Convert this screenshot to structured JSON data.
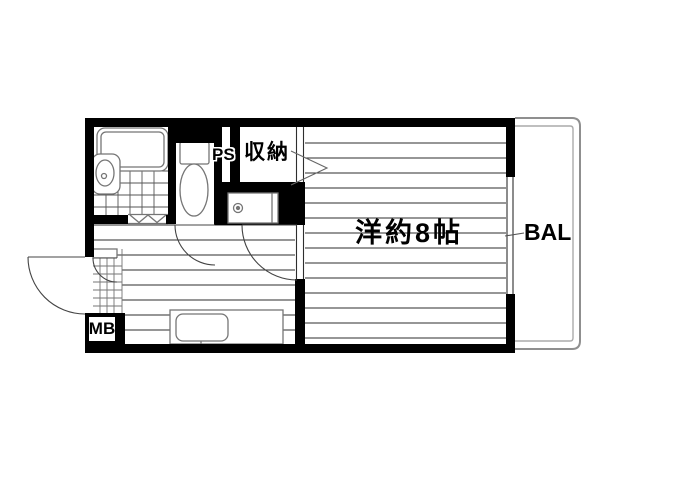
{
  "title": "One-room apartment floor plan",
  "labels": {
    "main_room": "洋約8帖",
    "balcony": "BAL",
    "storage": "収納",
    "pipe_space": "PS",
    "meter_box": "MB"
  },
  "colors": {
    "wall": "#000000",
    "floor_line": "#2e2e2e",
    "tile_line": "#555555",
    "fixture_line": "#757575",
    "arc_line": "#444444",
    "balcony_line": "#8f8f8f",
    "balcony_inner_line": "#aaaaaa",
    "background": "#ffffff"
  },
  "fixtures": [
    "bathtub",
    "washbasin",
    "bathroom-tile-floor",
    "bifold-bath-door",
    "toilet",
    "storage-closet",
    "pipe-space-shaft",
    "washing-machine-space",
    "kitchen-counter",
    "kitchen-sink",
    "entrance-door",
    "shoe-cabinet",
    "entrance-tile-floor",
    "meter-box",
    "window",
    "balcony-rail",
    "toilet-door",
    "main-room-door",
    "closet-opening-arrow",
    "balcony-leader-line"
  ]
}
